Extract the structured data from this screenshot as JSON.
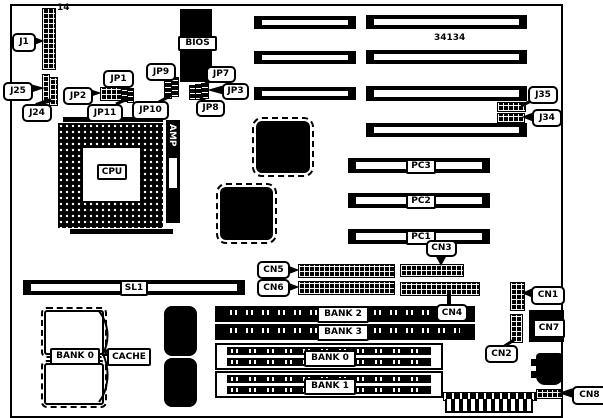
{
  "board": {
    "part_number": "34134",
    "pin_label": "14",
    "connectors": {
      "j1": "J1",
      "j25": "J25",
      "j24": "J24",
      "j35": "J35",
      "j34": "J34",
      "cn1": "CN1",
      "cn2": "CN2",
      "cn3": "CN3",
      "cn4": "CN4",
      "cn5": "CN5",
      "cn6": "CN6",
      "cn7": "CN7",
      "cn8": "CN8"
    },
    "jumpers": {
      "jp1": "JP1",
      "jp2": "JP2",
      "jp3": "JP3",
      "jp7": "JP7",
      "jp8": "JP8",
      "jp9": "JP9",
      "jp10": "JP10",
      "jp11": "JP11"
    },
    "chips": {
      "bios": "BIOS",
      "cpu": "CPU",
      "amp": "AMP",
      "cache": "CACHE",
      "cache_bank": "BANK 0"
    },
    "slots": {
      "sl1": "SL1",
      "pc1": "PC1",
      "pc2": "PC2",
      "pc3": "PC3"
    },
    "memory_banks": {
      "bank0": "BANK 0",
      "bank1": "BANK 1",
      "bank2": "BANK 2",
      "bank3": "BANK 3"
    },
    "colors": {
      "ink": "#000000",
      "background": "#ffffff"
    }
  }
}
